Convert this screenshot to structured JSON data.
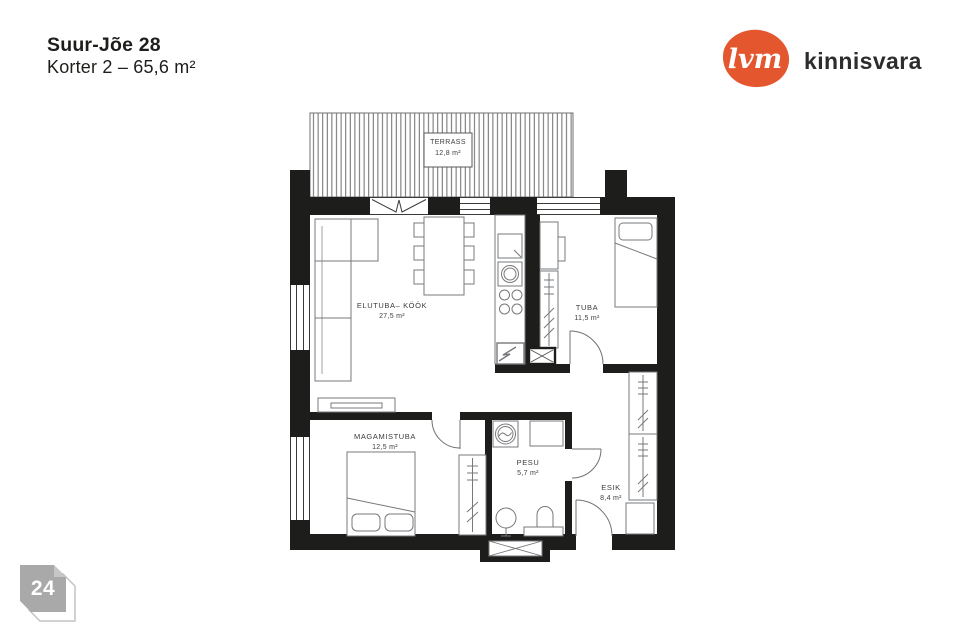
{
  "header": {
    "address": "Suur-Jõe 28",
    "subtitle": "Korter 2 – 65,6 m²"
  },
  "logo": {
    "mark": "lvm",
    "name": "kinnisvara",
    "accent_color": "#e4562e",
    "text_color": "#2d2d2d"
  },
  "page_badge": {
    "number": "24",
    "color": "#a9a9a9"
  },
  "floor_plan": {
    "wall_color": "#1d1d1b",
    "line_color": "#77787b",
    "rooms": [
      {
        "id": "terrass",
        "name": "TERRASS",
        "area": "12,8 m²"
      },
      {
        "id": "elutuba-kook",
        "name": "ELUTUBA– KÖÖK",
        "area": "27,5 m²"
      },
      {
        "id": "tuba",
        "name": "TUBA",
        "area": "11,5 m²"
      },
      {
        "id": "magamistuba",
        "name": "MAGAMISTUBA",
        "area": "12,5 m²"
      },
      {
        "id": "pesu",
        "name": "PESU",
        "area": "5,7 m²"
      },
      {
        "id": "esik",
        "name": "ESIK",
        "area": "8,4 m²"
      }
    ]
  }
}
